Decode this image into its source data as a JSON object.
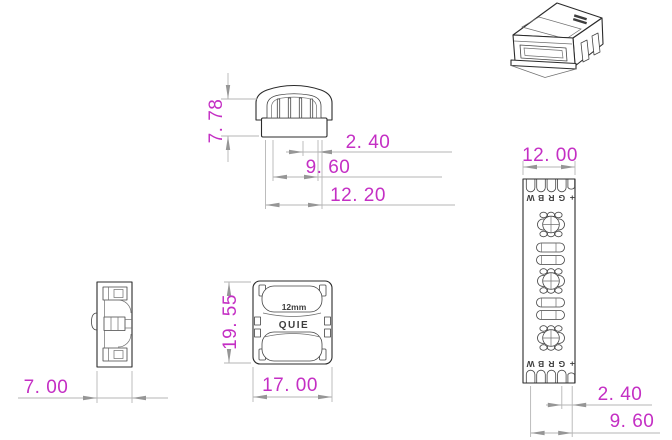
{
  "colors": {
    "background": "#ffffff",
    "outline": "#2b2b2b",
    "dimension_line": "#b5b5b5",
    "arrowhead": "#969696",
    "dimension_text": "#c42fc4",
    "marking_text": "#3d3d3d"
  },
  "front_view": {
    "dim_height": "7. 78",
    "dim_slot_pitch": "2. 40",
    "dim_slot_span": "9. 60",
    "dim_opening_width": "12. 20"
  },
  "top_view": {
    "marking_size": "12mm",
    "marking_brand": "QUIE",
    "dim_length": "19. 55",
    "dim_width": "17. 00"
  },
  "side_view": {
    "dim_width": "7. 00"
  },
  "strip_view": {
    "dim_width": "12. 00",
    "dim_pad_pitch": "2. 40",
    "dim_pad_span": "9. 60",
    "pad_labels": [
      "W",
      "B",
      "R",
      "G",
      "+"
    ]
  }
}
